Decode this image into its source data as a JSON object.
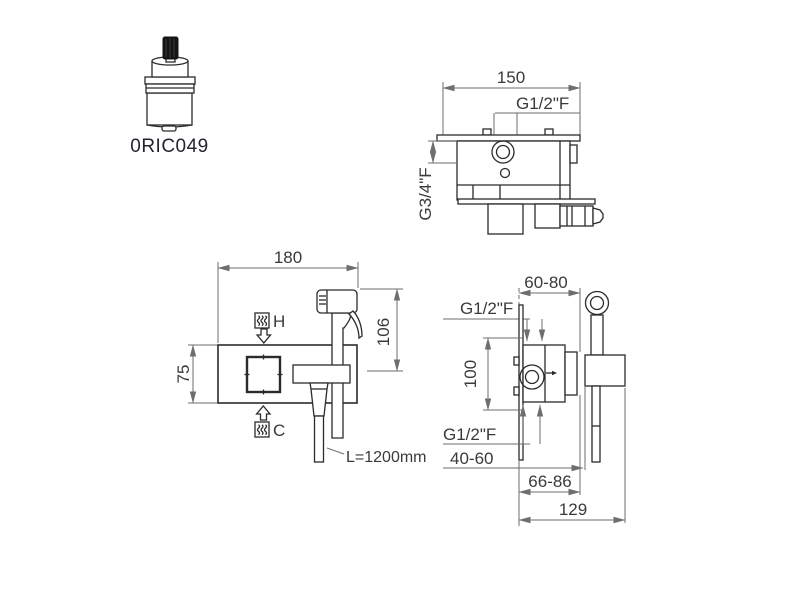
{
  "colors": {
    "background": "#ffffff",
    "object_line": "#2b2b2b",
    "dimension_line": "#6e6e6e",
    "text": "#3a3a3a"
  },
  "cartridge": {
    "code": "0RIC049"
  },
  "top_view": {
    "dim_width": "150",
    "label_top_inlet": "G1/2\"F",
    "label_side_outlet": "G3/4\"F"
  },
  "front_view": {
    "dim_width": "180",
    "dim_plate_height": "75",
    "dim_spray_height": "106",
    "label_hot": "H",
    "label_cold": "C",
    "label_hose_length": "L=1200mm",
    "hot_icon": "hot-water-icon",
    "cold_icon": "cold-water-icon"
  },
  "side_view": {
    "dim_depth_range": "60-80",
    "label_top_inlet": "G1/2\"F",
    "dim_body_height": "100",
    "label_bottom_outlet": "G1/2\"F",
    "dim_wall_depth": "40-60",
    "dim_holder_range": "66-86",
    "dim_total_depth": "129"
  }
}
